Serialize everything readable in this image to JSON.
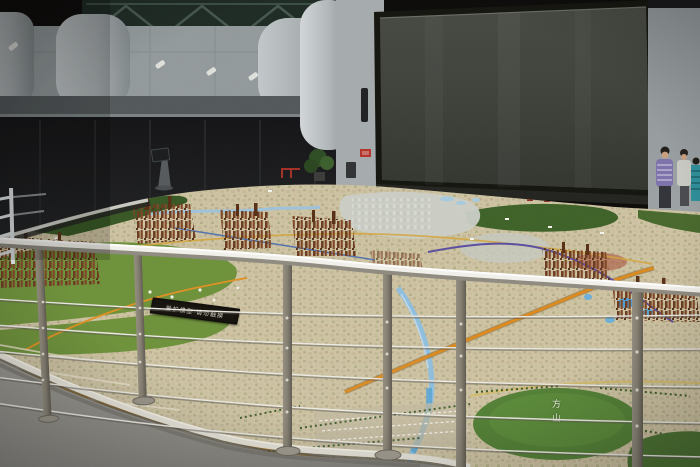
{
  "scene": {
    "type": "photograph",
    "setting": "urban-planning-exhibition-hall with giant city scale model",
    "texts": {
      "sign": "爱护模型 请勿触摸",
      "hill_label": "方山"
    },
    "visitors": [
      {
        "shirt": "purple-striped"
      },
      {
        "shirt": "light-gray"
      },
      {
        "shirt": "teal-striped"
      }
    ]
  },
  "colors": {
    "background": "#0d0b0a",
    "wall_gray": "#939a9c",
    "wall_light": "#a6abad",
    "screen_face": "#3e413a",
    "screen_frame": "#17170f",
    "model_base": "#cfc4a3",
    "field_green": "#6d9139",
    "hill_green": "#3c6126",
    "park_green": "#528034",
    "river_blue": "#8fbede",
    "lake_blue": "#4c9ed2",
    "road_orange": "#e08818",
    "metro_purple": "#5a4da0",
    "rail_metal": "#f2f0ea",
    "post_metal": "#847e71",
    "floor_concrete": "#8e8d87",
    "sign_bg": "#17130e",
    "shirt_striped": "#7d72aa",
    "shirt_light": "#c9cac4",
    "shirt_teal": "#2e8f9a"
  }
}
